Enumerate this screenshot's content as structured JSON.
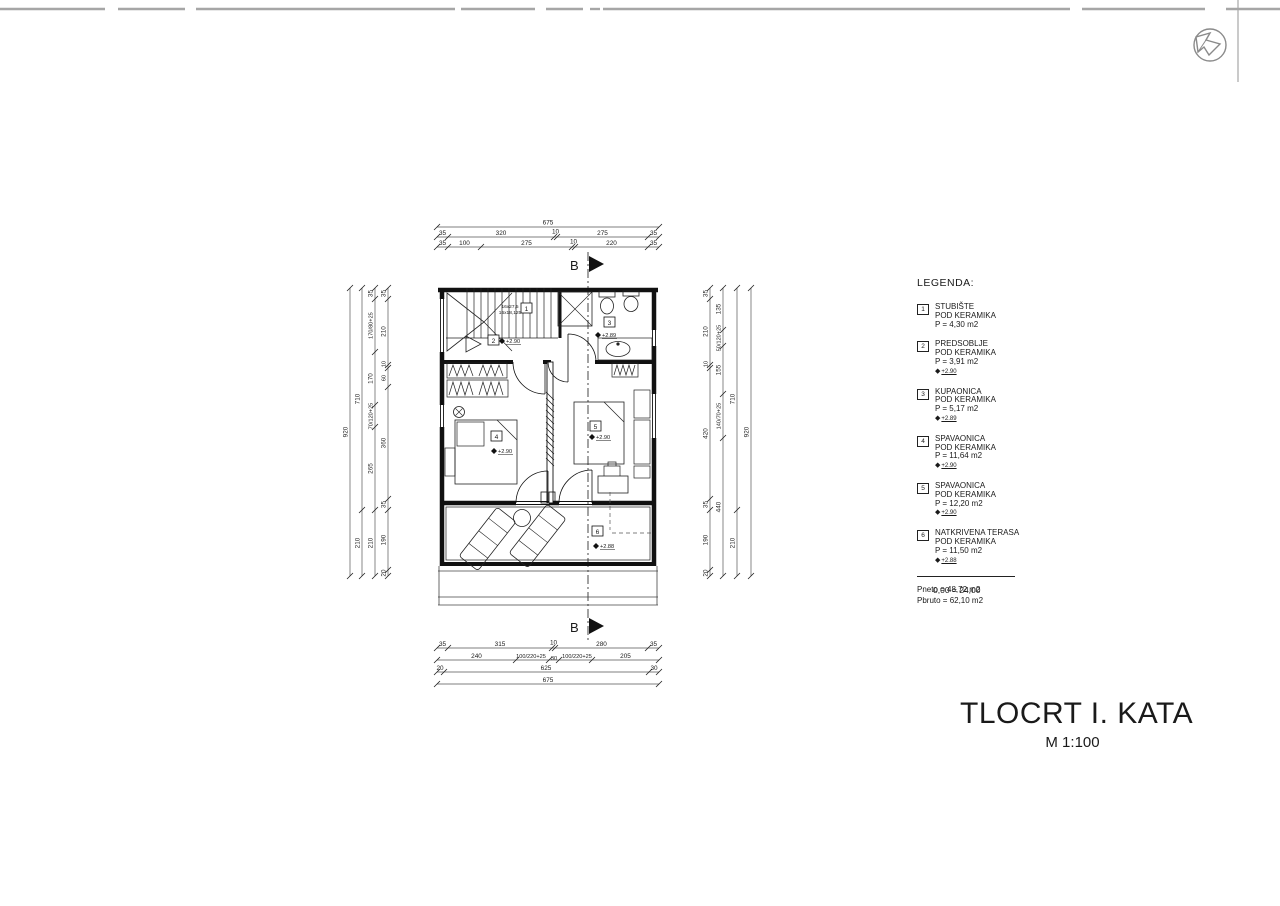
{
  "page": {
    "title": "TLOCRT I. KATA",
    "scale": "M 1:100",
    "datum": "0,00 = 24,00"
  },
  "section": {
    "label": "B"
  },
  "stair": {
    "line1": "16x27,5",
    "line2": "16x18,125"
  },
  "plan": {
    "rooms": [
      {
        "num": "1",
        "level": ""
      },
      {
        "num": "2",
        "level": "+2.90"
      },
      {
        "num": "3",
        "level": "+2.89"
      },
      {
        "num": "4",
        "level": "+2.90"
      },
      {
        "num": "5",
        "level": "+2.90"
      },
      {
        "num": "6",
        "level": "+2.88"
      }
    ]
  },
  "legend": {
    "title": "LEGENDA:",
    "items": [
      {
        "num": "1",
        "name": "STUBIŠTE",
        "floor": "POD KERAMIKA",
        "area": "P = 4,30 m2",
        "level": ""
      },
      {
        "num": "2",
        "name": "PREDSOBLJE",
        "floor": "POD KERAMIKA",
        "area": "P = 3,91 m2",
        "level": "+2.90"
      },
      {
        "num": "3",
        "name": "KUPAONICA",
        "floor": "POD KERAMIKA",
        "area": "P = 5,17 m2",
        "level": "+2.89"
      },
      {
        "num": "4",
        "name": "SPAVAONICA",
        "floor": "POD KERAMIKA",
        "area": "P = 11,64 m2",
        "level": "+2.90"
      },
      {
        "num": "5",
        "name": "SPAVAONICA",
        "floor": "POD KERAMIKA",
        "area": "P = 12,20 m2",
        "level": "+2.90"
      },
      {
        "num": "6",
        "name": "NATKRIVENA TERASA",
        "floor": "POD KERAMIKA",
        "area": "P = 11,50 m2",
        "level": "+2.88"
      }
    ],
    "totals": {
      "pneto": "Pneto = 48,72 m2",
      "pbruto": "Pbruto = 62,10 m2"
    }
  },
  "dims": {
    "t1": [
      "675"
    ],
    "t2": [
      "35",
      "320",
      "10",
      "275",
      "35"
    ],
    "t3": [
      "35",
      "100",
      "275",
      "10",
      "220",
      "35"
    ],
    "b1": [
      "35",
      "315",
      "10",
      "280",
      "35"
    ],
    "b2": [
      "240",
      "100/220+25",
      "30",
      "100/220+25",
      "205"
    ],
    "b3": [
      "20",
      "625",
      "30"
    ],
    "b4": [
      "675"
    ],
    "l1": [
      "920"
    ],
    "l2": [
      "710",
      "210"
    ],
    "l3": [
      "35",
      "170/80+25",
      "170",
      "70/120+25",
      "265",
      "210"
    ],
    "l4": [
      "35",
      "210",
      "10",
      "60",
      "360",
      "35",
      "190",
      "20"
    ],
    "r1": [
      "35",
      "210",
      "10",
      "420",
      "35",
      "190",
      "20"
    ],
    "r2": [
      "135",
      "50/120+25",
      "155",
      "140/70+25",
      "440"
    ],
    "r3": [
      "710",
      "210"
    ],
    "r4": [
      "920"
    ]
  }
}
